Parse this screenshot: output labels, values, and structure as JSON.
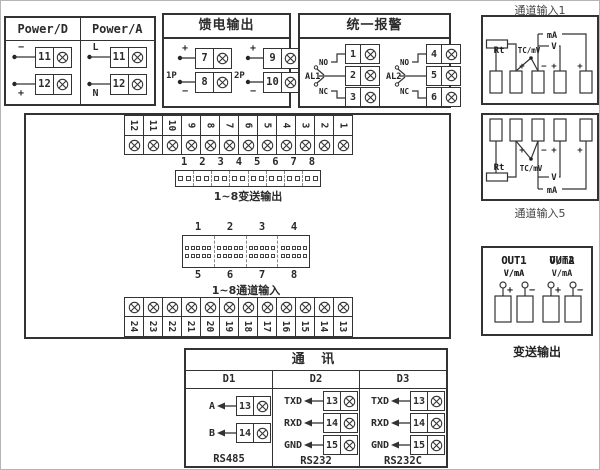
{
  "colors": {
    "line": "#333333",
    "background": "#ffffff"
  },
  "power_d": {
    "title": "Power/D",
    "rows": [
      {
        "sign": "−",
        "terminal": "11"
      },
      {
        "sign": "+",
        "terminal": "12"
      }
    ]
  },
  "power_a": {
    "title": "Power/A",
    "rows": [
      {
        "sign": "L",
        "terminal": "11"
      },
      {
        "sign": "N",
        "terminal": "12"
      }
    ]
  },
  "feed_output": {
    "title": "馈电输出",
    "groups": [
      {
        "name": "1P",
        "rows": [
          {
            "sign": "+",
            "terminal": "7"
          },
          {
            "sign": "−",
            "terminal": "8"
          }
        ]
      },
      {
        "name": "2P",
        "rows": [
          {
            "sign": "+",
            "terminal": "9"
          },
          {
            "sign": "−",
            "terminal": "10"
          }
        ]
      }
    ]
  },
  "alarm": {
    "title": "统一报警",
    "relays": [
      {
        "name": "AL1",
        "no_label": "NO",
        "nc_label": "NC",
        "terminals": [
          "1",
          "2",
          "3"
        ]
      },
      {
        "name": "AL2",
        "no_label": "NO",
        "nc_label": "NC",
        "terminals": [
          "4",
          "5",
          "6"
        ]
      }
    ]
  },
  "channel_input_top": {
    "label": "通道输入1",
    "rt": "Rt",
    "tc": "TC/mV",
    "v": "V",
    "ma": "mA",
    "plus": "+",
    "minus": "−"
  },
  "channel_input_bottom": {
    "label": "通道输入5",
    "rt": "Rt",
    "tc": "TC/mV",
    "v": "V",
    "ma": "mA",
    "plus": "+",
    "minus": "−"
  },
  "transmit_output": {
    "label": "变送输出",
    "outputs": [
      {
        "name": "OUT1",
        "type": "V/mA"
      },
      {
        "name": "OUT2",
        "type": "V/mA"
      }
    ],
    "signs": [
      "+",
      "−",
      "+",
      "−"
    ]
  },
  "central": {
    "top_strip": [
      "12",
      "11",
      "10",
      "9",
      "8",
      "7",
      "6",
      "5",
      "4",
      "3",
      "2",
      "1"
    ],
    "bottom_strip": [
      "24",
      "23",
      "22",
      "21",
      "20",
      "19",
      "18",
      "17",
      "16",
      "15",
      "14",
      "13"
    ],
    "transmit_connector": {
      "numbers": [
        "1",
        "2",
        "3",
        "4",
        "5",
        "6",
        "7",
        "8"
      ],
      "label": "1~8变送输出"
    },
    "channel_connector": {
      "top_numbers": [
        "1",
        "2",
        "3",
        "4"
      ],
      "bottom_numbers": [
        "5",
        "6",
        "7",
        "8"
      ],
      "label": "1~8通道输入"
    }
  },
  "comm": {
    "title": "通 讯",
    "columns": [
      {
        "header": "D1",
        "standard": "RS485",
        "rows": [
          {
            "signal": "A",
            "terminal": "13"
          },
          {
            "signal": "B",
            "terminal": "14"
          }
        ]
      },
      {
        "header": "D2",
        "standard": "RS232",
        "rows": [
          {
            "signal": "TXD",
            "terminal": "13"
          },
          {
            "signal": "RXD",
            "terminal": "14"
          },
          {
            "signal": "GND",
            "terminal": "15"
          }
        ]
      },
      {
        "header": "D3",
        "standard": "RS232C",
        "rows": [
          {
            "signal": "TXD",
            "terminal": "13"
          },
          {
            "signal": "RXD",
            "terminal": "14"
          },
          {
            "signal": "GND",
            "terminal": "15"
          }
        ]
      }
    ]
  }
}
